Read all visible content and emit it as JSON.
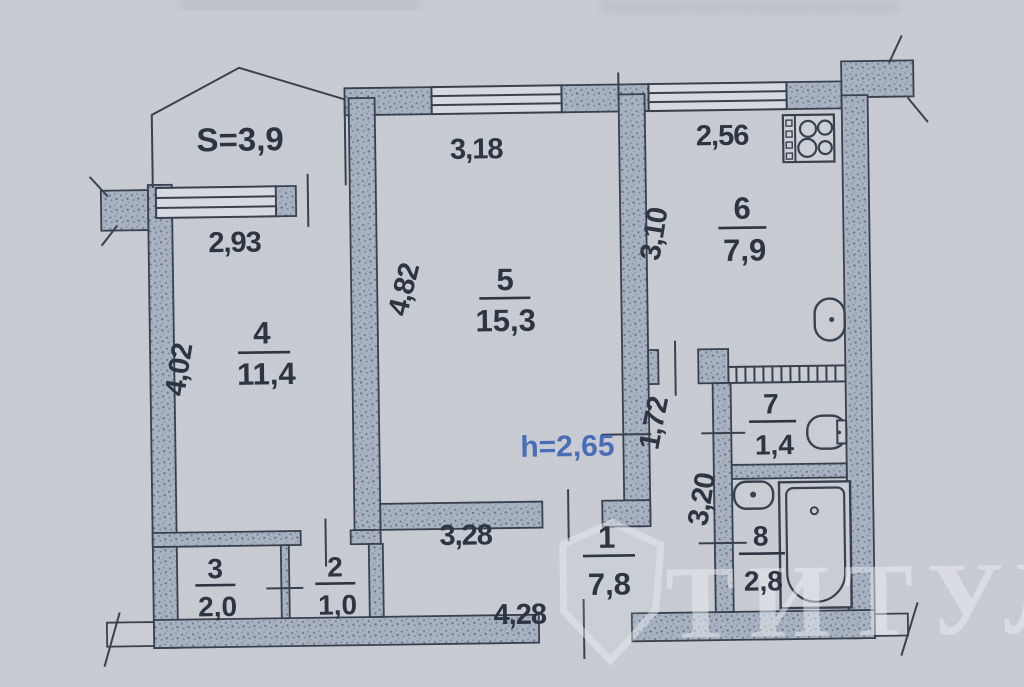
{
  "labels": {
    "balcony_area": "S=3,9",
    "height": "h=2,65",
    "watermark": "ТИТУЛ"
  },
  "dimensions": {
    "room4_width": "2,93",
    "room4_depth": "4,02",
    "room5_width": "3,18",
    "room5_depth": "4,82",
    "kitchen_width": "2,56",
    "kitchen_depth": "3,10",
    "corridor_width": "1,72",
    "corridor_length": "3,20",
    "hall_width": "3,28",
    "hall_length": "4,28"
  },
  "rooms": {
    "r1": {
      "number": "1",
      "area": "7,8"
    },
    "r2": {
      "number": "2",
      "area": "1,0"
    },
    "r3": {
      "number": "3",
      "area": "2,0"
    },
    "r4": {
      "number": "4",
      "area": "11,4"
    },
    "r5": {
      "number": "5",
      "area": "15,3"
    },
    "r6": {
      "number": "6",
      "area": "7,9"
    },
    "r7": {
      "number": "7",
      "area": "1,4"
    },
    "r8": {
      "number": "8",
      "area": "2,8"
    }
  },
  "fixtures": [
    "stove",
    "kitchen-sink",
    "toilet",
    "washbasin",
    "bathtub",
    "ventilation-shaft"
  ],
  "colors": {
    "paper": "#c9ccd3",
    "wall_fill": "#a8b2c0",
    "line": "#39414f",
    "text": "#2d3442",
    "height_accent": "#4a6db8",
    "watermark": "#eceef2"
  }
}
